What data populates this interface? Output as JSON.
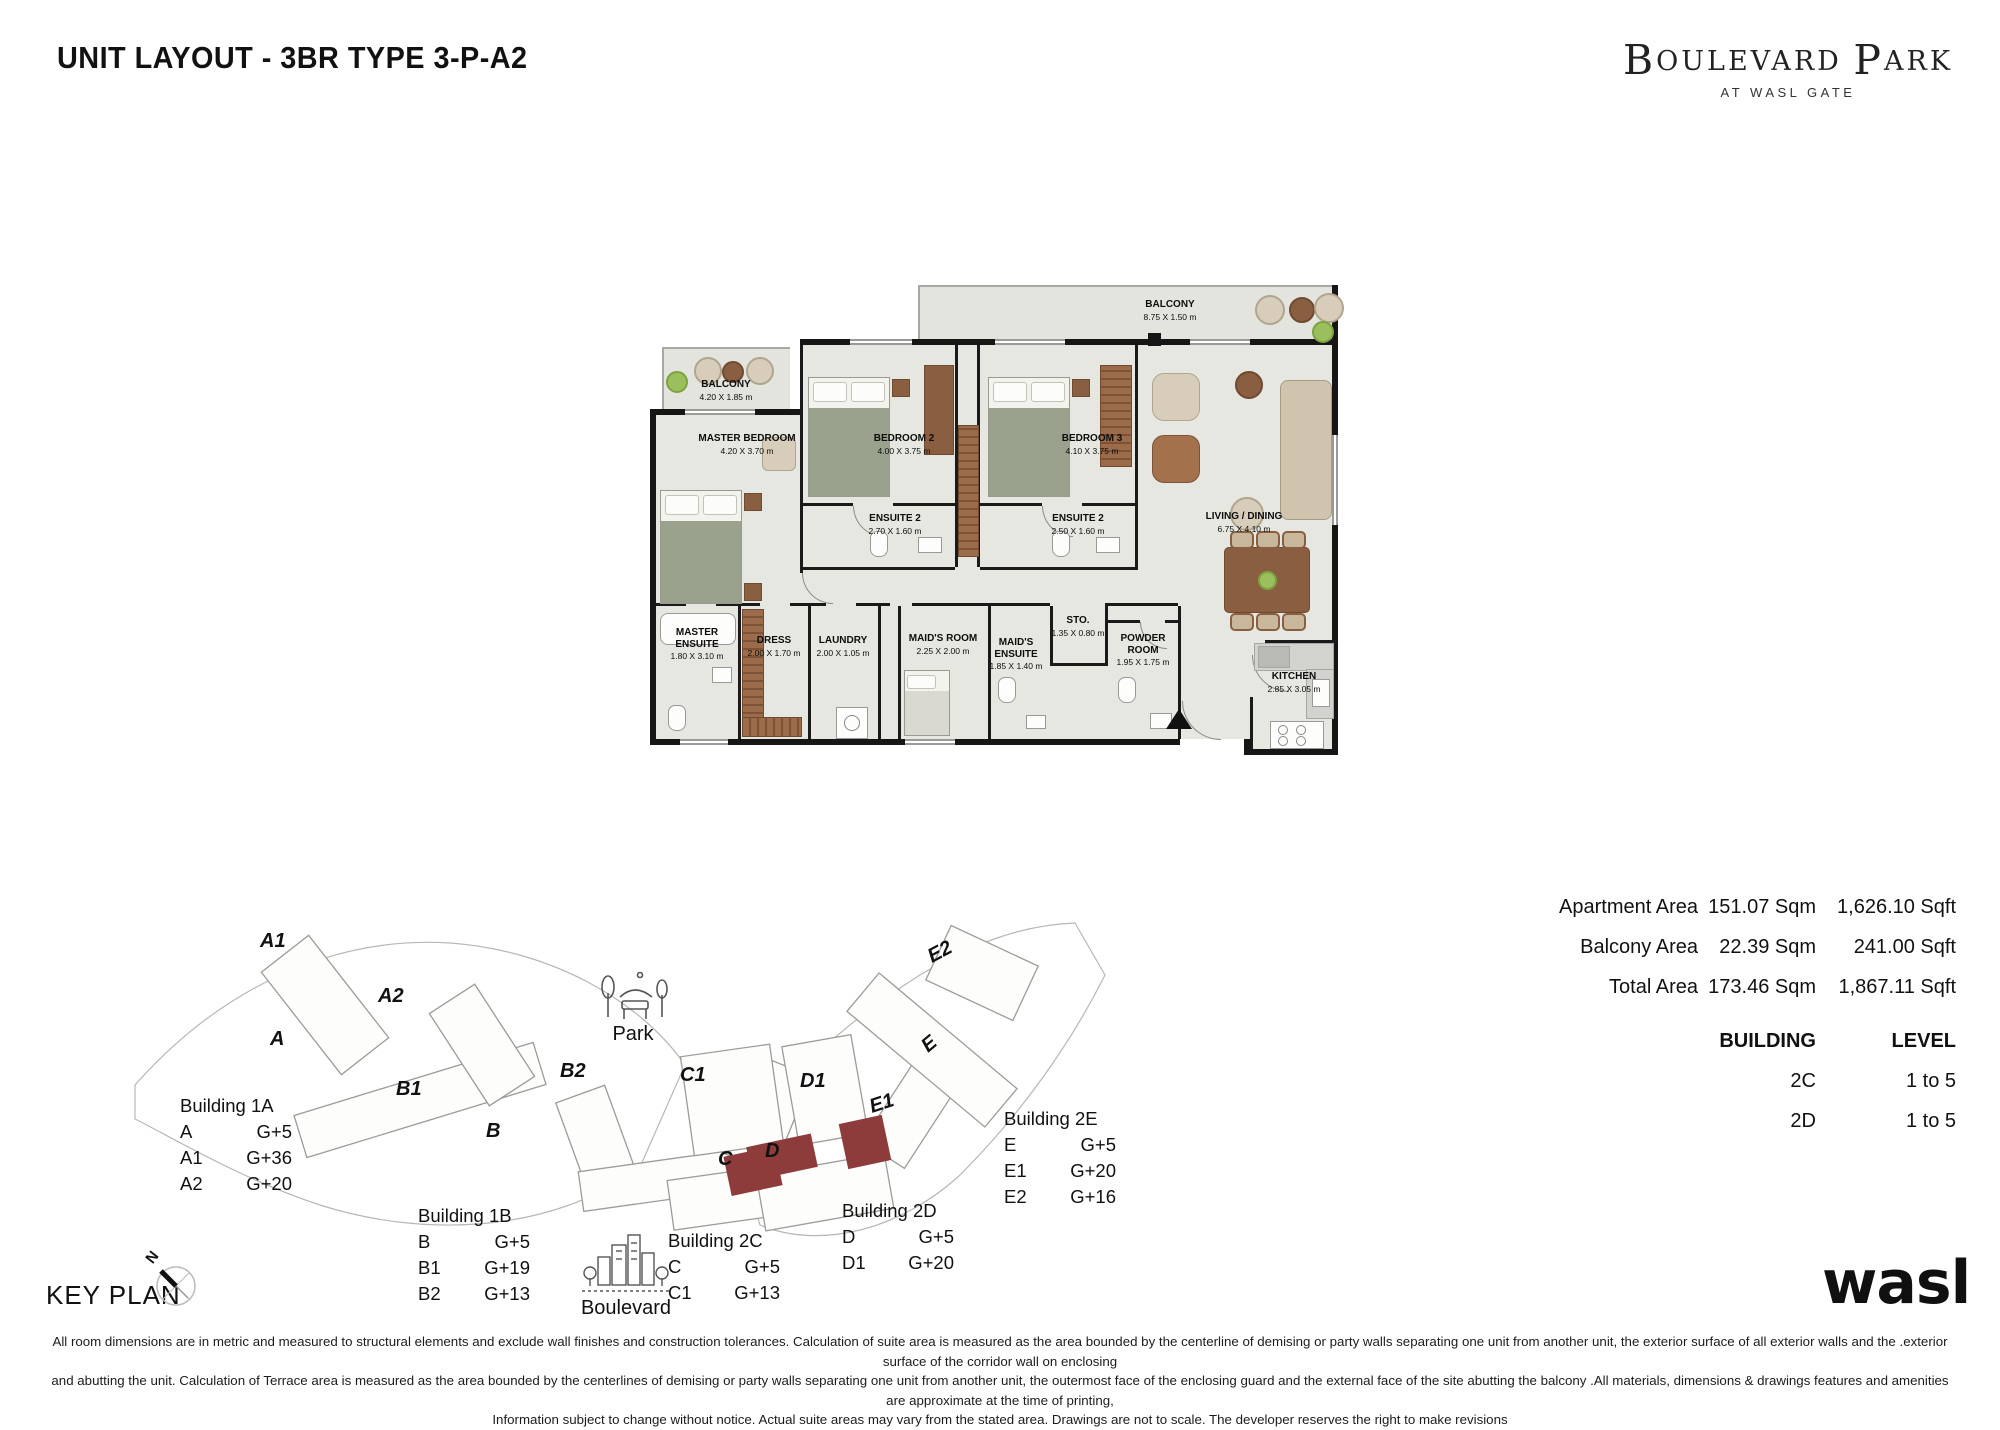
{
  "title": "UNIT LAYOUT - 3BR TYPE 3-P-A2",
  "brand": {
    "initial_1": "B",
    "rest_1": "OULEVARD",
    "initial_2": "P",
    "rest_2": "ARK",
    "tagline": "AT WASL GATE"
  },
  "plan": {
    "rooms": [
      {
        "name": "BALCONY",
        "dims": "8.75 X 1.50 m"
      },
      {
        "name": "BALCONY",
        "dims": "4.20 X 1.85 m"
      },
      {
        "name": "MASTER BEDROOM",
        "dims": "4.20 X 3.70 m"
      },
      {
        "name": "BEDROOM 2",
        "dims": "4.00 X 3.75 m"
      },
      {
        "name": "BEDROOM 3",
        "dims": "4.10 X 3.75 m"
      },
      {
        "name": "ENSUITE 2",
        "dims": "2.70 X 1.60 m"
      },
      {
        "name": "ENSUITE 2",
        "dims": "2.50 X 1.60 m"
      },
      {
        "name": "LIVING / DINING",
        "dims": "6.75 X 4.10 m"
      },
      {
        "name": "MASTER ENSUITE",
        "dims": "1.80 X 3.10 m"
      },
      {
        "name": "DRESS",
        "dims": "2.00 X 1.70 m"
      },
      {
        "name": "LAUNDRY",
        "dims": "2.00 X 1.05 m"
      },
      {
        "name": "MAID'S ROOM",
        "dims": "2.25 X 2.00 m"
      },
      {
        "name": "MAID'S ENSUITE",
        "dims": "1.85 X 1.40 m"
      },
      {
        "name": "STO.",
        "dims": "1.35 X 0.80 m"
      },
      {
        "name": "POWDER ROOM",
        "dims": "1.95 X 1.75 m"
      },
      {
        "name": "KITCHEN",
        "dims": "2.85 X 3.05 m"
      }
    ]
  },
  "areas": {
    "rows": [
      {
        "label": "Apartment Area",
        "sqm": "151.07 Sqm",
        "sqft": "1,626.10 Sqft"
      },
      {
        "label": "Balcony Area",
        "sqm": "22.39 Sqm",
        "sqft": "241.00 Sqft"
      },
      {
        "label": "Total Area",
        "sqm": "173.46 Sqm",
        "sqft": "1,867.11 Sqft"
      }
    ]
  },
  "building_table": {
    "headers": {
      "building": "BUILDING",
      "level": "LEVEL"
    },
    "rows": [
      {
        "building": "2C",
        "level": "1 to 5"
      },
      {
        "building": "2D",
        "level": "1 to 5"
      }
    ]
  },
  "keyplan": {
    "title": "KEY PLAN",
    "compass_label": "N",
    "park_label": "Park",
    "boulevard_label": "Boulevard",
    "map_labels": [
      "A1",
      "A2",
      "A",
      "B1",
      "B",
      "B2",
      "C1",
      "C",
      "D1",
      "D",
      "E1",
      "E",
      "E2"
    ],
    "groups": [
      {
        "title": "Building 1A",
        "rows": [
          [
            "A",
            "G+5"
          ],
          [
            "A1",
            "G+36"
          ],
          [
            "A2",
            "G+20"
          ]
        ]
      },
      {
        "title": "Building 1B",
        "rows": [
          [
            "B",
            "G+5"
          ],
          [
            "B1",
            "G+19"
          ],
          [
            "B2",
            "G+13"
          ]
        ]
      },
      {
        "title": "Building 2C",
        "rows": [
          [
            "C",
            "G+5"
          ],
          [
            "C1",
            "G+13"
          ]
        ]
      },
      {
        "title": "Building 2D",
        "rows": [
          [
            "D",
            "G+5"
          ],
          [
            "D1",
            "G+20"
          ]
        ]
      },
      {
        "title": "Building 2E",
        "rows": [
          [
            "E",
            "G+5"
          ],
          [
            "E1",
            "G+20"
          ],
          [
            "E2",
            "G+16"
          ]
        ]
      }
    ]
  },
  "footer": {
    "disclaimer_lines": [
      "All room dimensions are in metric and measured to structural elements and exclude wall finishes and construction tolerances. Calculation of suite area is measured as the area bounded by the centerline of demising or party walls separating one unit from another unit, the exterior surface of all exterior walls and the .exterior surface of the corridor wall on enclosing",
      "and abutting the unit. Calculation of Terrace area is measured as the area bounded by the centerlines of demising or party walls separating one unit from another unit, the outermost face of the enclosing guard and the external face of the site abutting the balcony .All materials, dimensions & drawings features and amenities are approximate at the time of printing,",
      "Information subject to change without notice. Actual suite areas may vary from the stated area. Drawings are not to scale. The developer reserves the right to make revisions"
    ],
    "logo": "wasl"
  },
  "colors": {
    "wall": "#161616",
    "floor": "#e7e7e1",
    "unit_highlight": "#8e3b3b"
  }
}
